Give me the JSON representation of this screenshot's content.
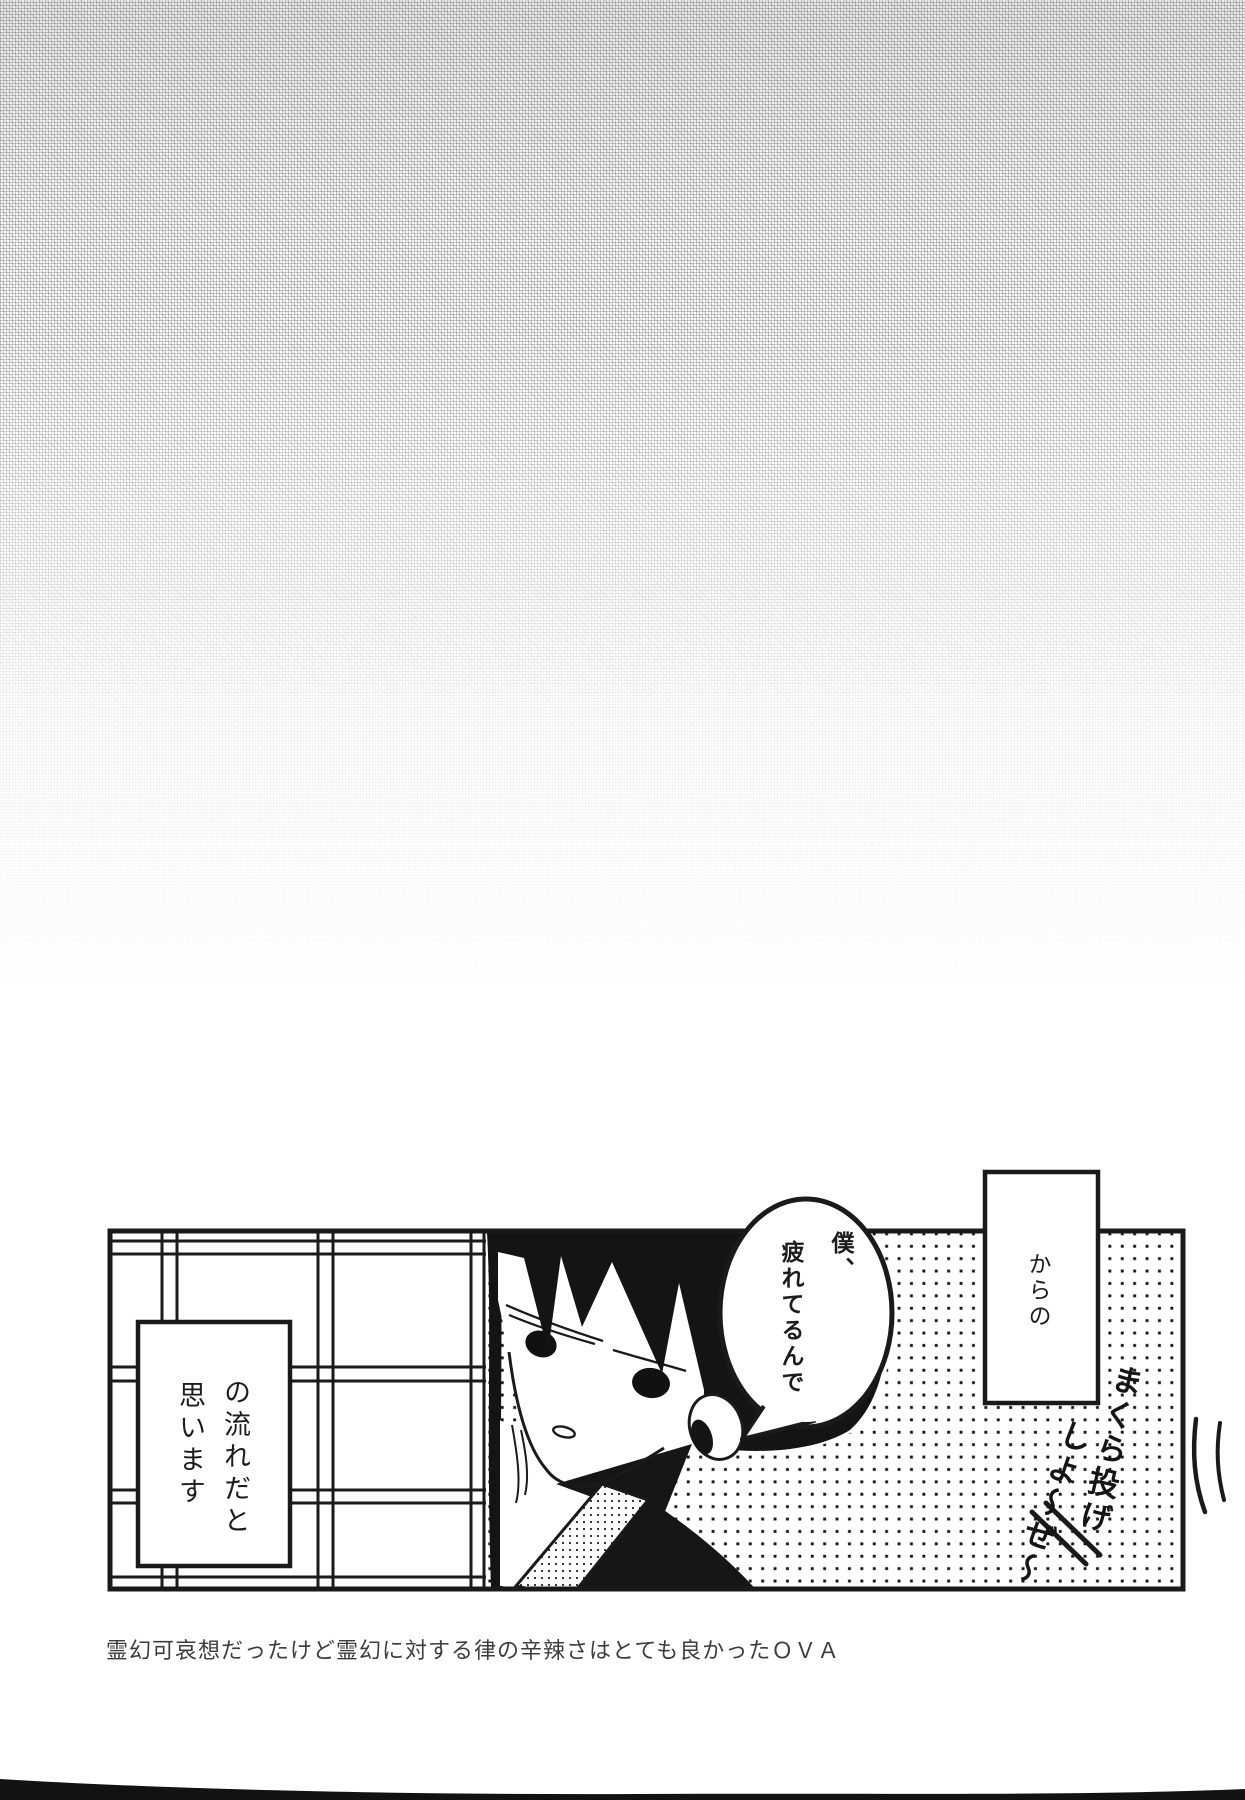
{
  "page_type": "manga-afterword-scan",
  "colors": {
    "ink": "#1a1a1a",
    "paper": "#ffffff",
    "texture_gray": "#cccccc"
  },
  "panel": {
    "narration_box_right": {
      "text": "からの"
    },
    "narration_box_left": {
      "col_right": "の流れだと",
      "col_left": "思います",
      "full_text": "の流れだと思います"
    },
    "speech_bubble": {
      "col_right": "僕、",
      "col_left": "疲れてるんで",
      "full_text": "僕、疲れてるんで"
    },
    "handwriting": {
      "col_right": "まくら投げ",
      "col_left": "しよ〜ぜ〜",
      "full_text": "まくら投げしよ〜ぜ〜"
    },
    "art_elements": {
      "background": "polka-dot-screentone",
      "left_scene": "shoji-sliding-door-grid",
      "character": "black-haired-boy-peeking-from-door"
    }
  },
  "caption": {
    "text": "霊幻可哀想だったけど霊幻に対する律の辛辣さはとても良かったＯＶＡ"
  }
}
